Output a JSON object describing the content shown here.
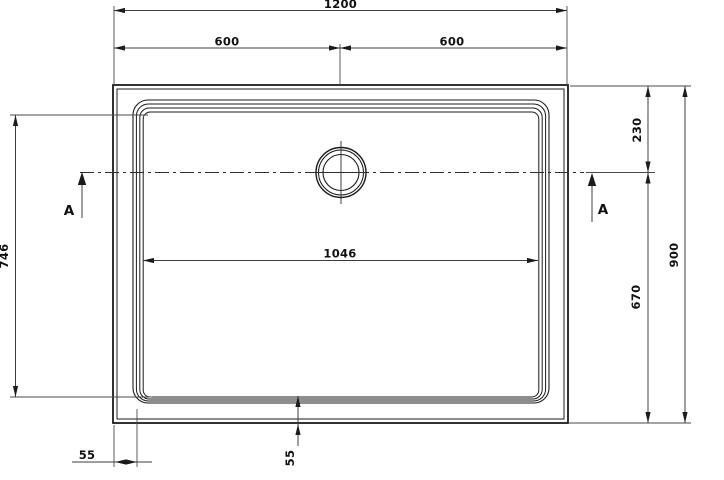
{
  "drawing": {
    "type_note": "top-view technical drawing of rectangular shower tray with central drain",
    "section_label": "A",
    "dimensions": {
      "overall_width": "1200",
      "half_width_left": "600",
      "half_width_right": "600",
      "basin_inner_width": "1046",
      "basin_inner_height": "746",
      "drain_offset_from_top": "230",
      "drain_offset_from_bottom": "670",
      "overall_height": "900",
      "rim_margin_left": "55",
      "rim_margin_bottom": "55"
    },
    "colors": {
      "object_line": "#1b1b1b",
      "dimension_line": "#3d3d3d",
      "background": "#ffffff"
    }
  }
}
